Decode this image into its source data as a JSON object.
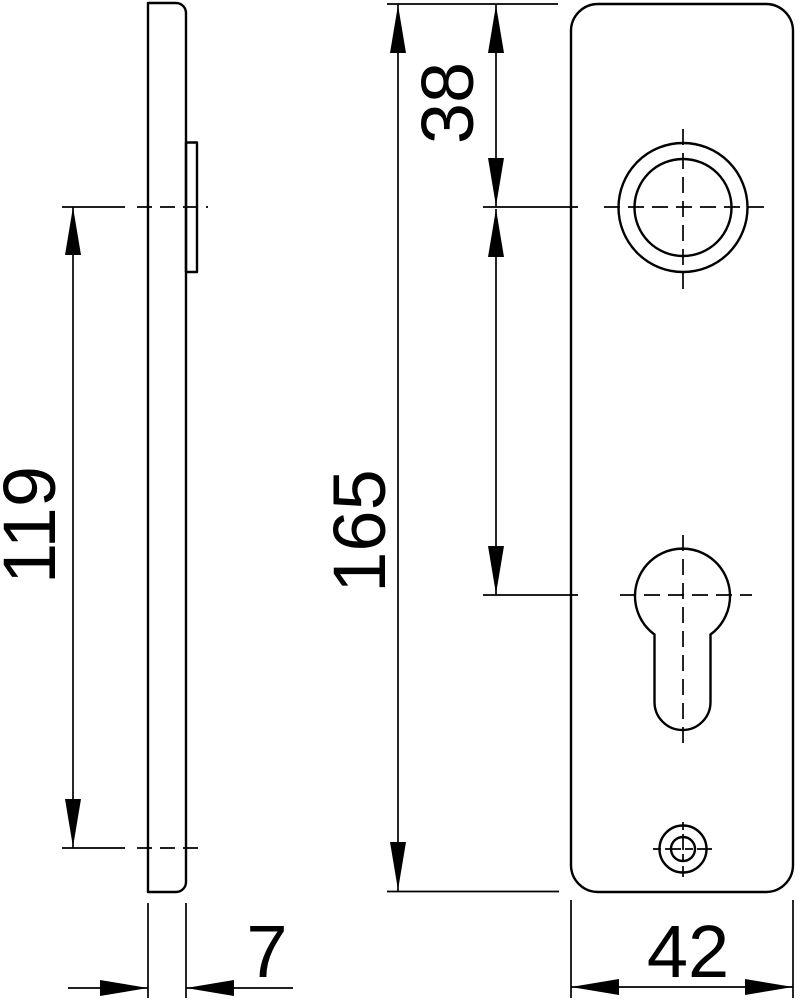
{
  "colors": {
    "background": "#ffffff",
    "line": "#000000"
  },
  "drawing": {
    "kind": "two-view dimensioned technical drawing of a door short plate (escutcheon)",
    "views": {
      "side_view": "side-profile-of-plate",
      "front_view": "front-face-of-plate-with-handle-hole-cylinder-keyhole-and-screw-hole"
    },
    "dimensions": {
      "top_to_handle_center": "38",
      "plate_height": "165",
      "hole_spacing": "119",
      "plate_thickness": "7",
      "plate_width": "42"
    }
  }
}
